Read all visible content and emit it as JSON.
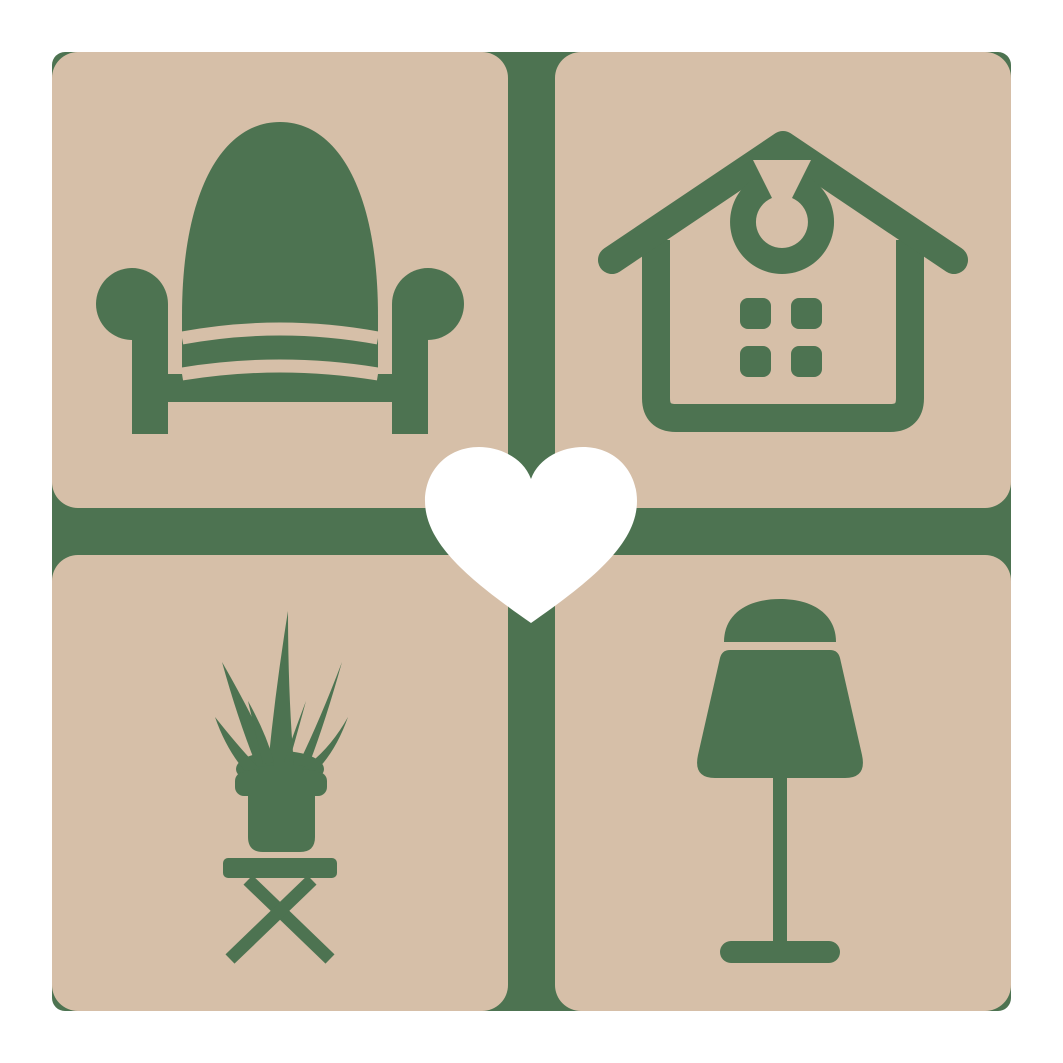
{
  "logo": {
    "description": "Home and furniture brand logo: four rounded tiles with interior icons around a central heart",
    "colors": {
      "background": "#ffffff",
      "tile_tan": "#d6bfa8",
      "icon_green": "#4d7351",
      "heart_white": "#ffffff"
    },
    "tiles": [
      {
        "position": "top-left",
        "icon": "armchair-icon",
        "subject": "armchair"
      },
      {
        "position": "top-right",
        "icon": "house-icon",
        "subject": "house with window and door-wreath ornament"
      },
      {
        "position": "bottom-left",
        "icon": "potted-plant-icon",
        "subject": "potted plant on folding stool"
      },
      {
        "position": "bottom-right",
        "icon": "table-lamp-icon",
        "subject": "table lamp"
      }
    ],
    "center": {
      "icon": "heart-icon",
      "subject": "heart"
    }
  }
}
